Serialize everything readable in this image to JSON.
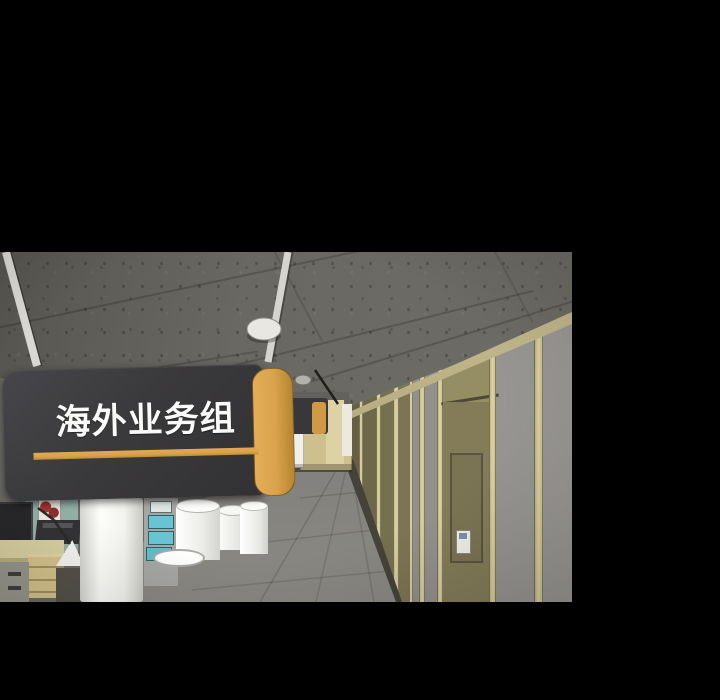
{
  "panel": {
    "description": "Comic panel: 3D-rendered office hallway seen from the ceiling corner, with a dark hanging department sign, a row of olive doors on the right wall and office furniture below",
    "sign": {
      "label": "海外业务组"
    },
    "colors": {
      "background": "#000000",
      "ceiling": "#666460",
      "wall": "#8f8e8a",
      "trim": "#d9cf9d",
      "door": "#847c59",
      "floor": "#7d7c78",
      "sign_bg": "#3a393b",
      "sign_accent": "#d9a24b",
      "sign_text": "#fafaf8",
      "partition": "#93b1a8",
      "poster_red": "#a83434",
      "furniture_beige": "#d5c38c",
      "pillar_white": "#f2f2ee"
    }
  }
}
